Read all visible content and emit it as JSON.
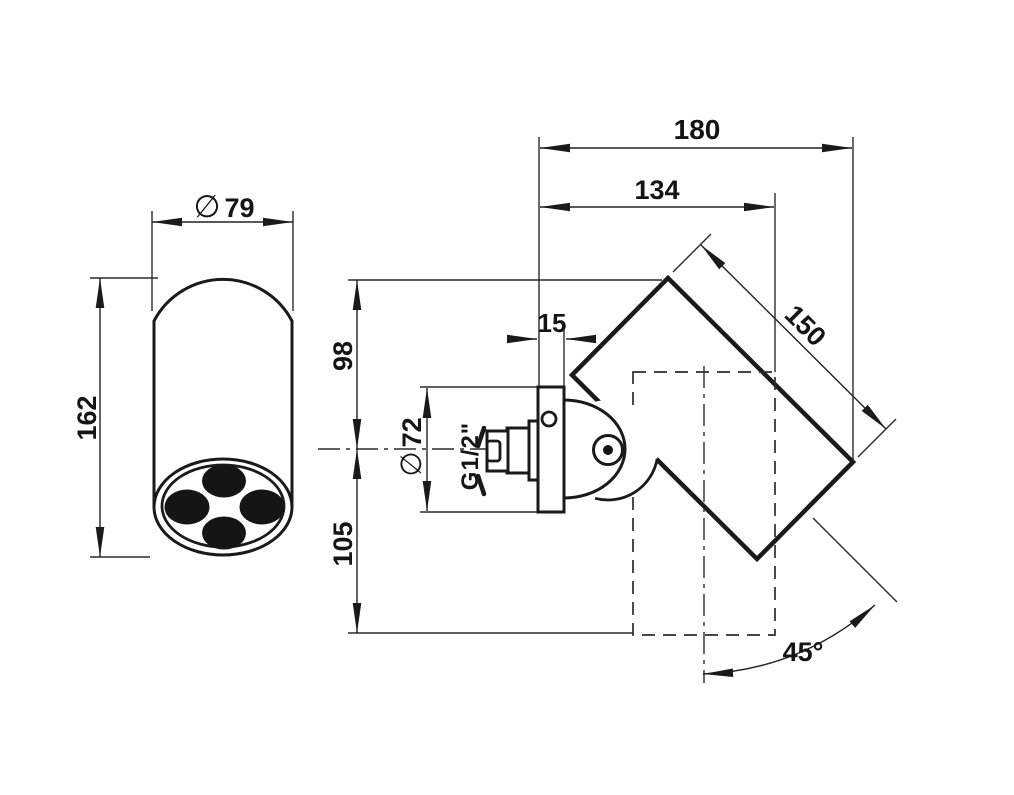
{
  "drawing": {
    "background": "#ffffff",
    "line_color": "#1a1a1a",
    "front_view": {
      "diameter_symbol": "∅",
      "diameter_value": "79",
      "height": "162"
    },
    "side_view": {
      "total_depth": "180",
      "body_offset": "134",
      "plate_thickness": "15",
      "above_axis": "98",
      "below_axis": "105",
      "plate_diameter_symbol": "∅",
      "plate_diameter_value": "72",
      "thread": "G1/2\"",
      "body_length": "150",
      "swivel_angle": "45°"
    }
  }
}
